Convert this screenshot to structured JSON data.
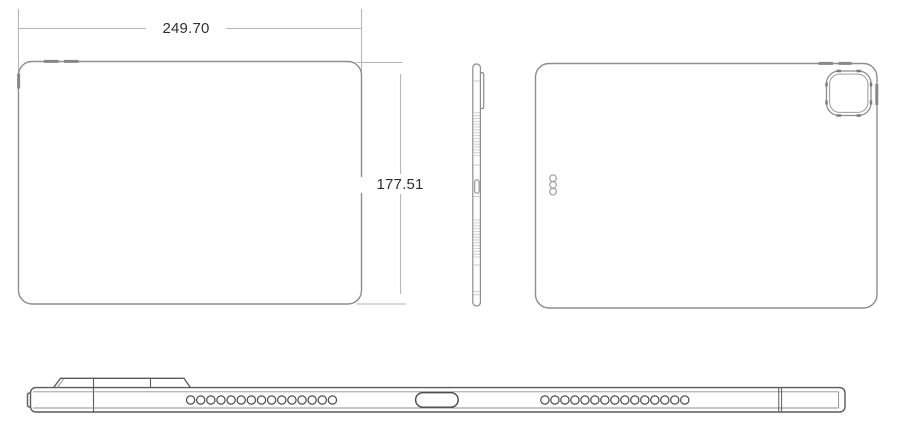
{
  "dimensions": {
    "width_mm": "249.70",
    "height_mm": "177.51"
  },
  "colors": {
    "outline": "#8d8d8d",
    "outline_strong": "#5a5a5a",
    "detail_line": "#9c9c9c",
    "dimension_line": "#b6b6b6",
    "label_text": "#2f2f2f",
    "background": "#ffffff"
  },
  "views": {
    "front": {
      "volume_buttons": 2,
      "top_button": 1
    },
    "side": {
      "speaker_dot_rows": [
        16,
        14
      ],
      "speaker_dot_cols": 3,
      "camera_bump": 1,
      "port": 1
    },
    "back": {
      "smart_connector_dots": 3,
      "volume_buttons": 2,
      "power_button": 1,
      "camera_rings": 2
    },
    "bottom": {
      "speaker_holes_left": 15,
      "speaker_holes_right": 15,
      "usb_c_port": 1,
      "camera_plateau_sections": 2
    }
  }
}
